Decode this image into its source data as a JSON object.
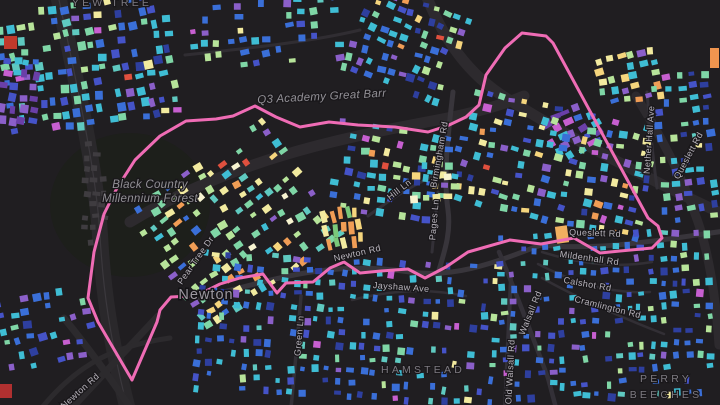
{
  "map": {
    "background": "#201e21",
    "forest_patch": {
      "cx": 130,
      "cy": 205,
      "rx": 80,
      "ry": 72,
      "color": "#1d1f1b"
    },
    "boundary": {
      "name": "ward-boundary",
      "color": "#ef6cb5",
      "width": 3,
      "points": [
        [
          132,
          380
        ],
        [
          98,
          322
        ],
        [
          88,
          298
        ],
        [
          94,
          252
        ],
        [
          104,
          214
        ],
        [
          117,
          188
        ],
        [
          135,
          160
        ],
        [
          160,
          136
        ],
        [
          186,
          121
        ],
        [
          216,
          119
        ],
        [
          233,
          116
        ],
        [
          255,
          106
        ],
        [
          276,
          117
        ],
        [
          300,
          127
        ],
        [
          329,
          122
        ],
        [
          358,
          125
        ],
        [
          395,
          127
        ],
        [
          428,
          132
        ],
        [
          447,
          126
        ],
        [
          466,
          117
        ],
        [
          479,
          105
        ],
        [
          486,
          75
        ],
        [
          505,
          48
        ],
        [
          522,
          33
        ],
        [
          546,
          36
        ],
        [
          553,
          43
        ],
        [
          648,
          218
        ],
        [
          658,
          226
        ],
        [
          662,
          238
        ],
        [
          652,
          248
        ],
        [
          620,
          251
        ],
        [
          600,
          253
        ],
        [
          574,
          238
        ],
        [
          541,
          244
        ],
        [
          510,
          240
        ],
        [
          468,
          252
        ],
        [
          446,
          267
        ],
        [
          425,
          278
        ],
        [
          408,
          269
        ],
        [
          381,
          271
        ],
        [
          360,
          273
        ],
        [
          344,
          262
        ],
        [
          330,
          268
        ],
        [
          313,
          282
        ],
        [
          286,
          283
        ],
        [
          277,
          293
        ],
        [
          263,
          274
        ],
        [
          240,
          278
        ],
        [
          220,
          284
        ],
        [
          206,
          291
        ],
        [
          190,
          296
        ],
        [
          171,
          297
        ],
        [
          160,
          310
        ],
        [
          157,
          322
        ],
        [
          132,
          380
        ]
      ]
    },
    "roads": [
      {
        "d": "M 58,-5 C 78,90 96,170 100,235 C 103,290 110,340 128,410",
        "w": 16,
        "c": "#2a282b"
      },
      {
        "d": "M 58,-5 C 78,90 96,170 100,235 C 103,290 110,340 128,410",
        "w": 1.2,
        "c": "#3b383d"
      },
      {
        "d": "M 158,316 L 70,410",
        "w": 7,
        "c": "#2c2a2d"
      },
      {
        "d": "M 64,318 C 90,350 108,375 132,410",
        "w": 7,
        "c": "#2c2a2d"
      },
      {
        "d": "M 40,410 C 80,360 120,345 170,338",
        "w": 5,
        "c": "#2c2a2d"
      },
      {
        "d": "M 130,222 C 230,162 330,140 432,121 C 470,114 500,106 524,96",
        "w": 11,
        "c": "#2d2a2e"
      },
      {
        "d": "M 426,-5 C 444,40 468,74 506,98 C 570,138 650,180 725,215",
        "w": 11,
        "c": "#2d2a2e"
      },
      {
        "d": "M 636,96 C 660,135 682,175 698,222 C 710,258 716,300 719,345",
        "w": 9,
        "c": "#2d2a2e"
      },
      {
        "d": "M 200,298 C 280,278 330,260 410,272 C 460,279 505,258 541,245 C 600,251 660,240 725,231",
        "w": 5,
        "c": "#38353b"
      },
      {
        "d": "M 453,92 C 448,135 443,175 448,210 C 451,232 445,250 439,270",
        "w": 5,
        "c": "#38353b"
      },
      {
        "d": "M 301,296 C 298,332 295,368 291,408",
        "w": 3.5,
        "c": "#333037"
      },
      {
        "d": "M 511,276 C 509,315 507,360 505,408",
        "w": 4,
        "c": "#333037"
      },
      {
        "d": "M 499,252 C 516,292 532,335 548,378 L 556,408",
        "w": 4.5,
        "c": "#333037"
      },
      {
        "d": "M 368,216 C 390,200 410,186 434,176",
        "w": 3,
        "c": "#333037"
      },
      {
        "d": "M 438,192 L 432,252",
        "w": 3,
        "c": "#333037"
      },
      {
        "d": "M 647,92 C 650,128 653,158 657,188",
        "w": 3,
        "c": "#333037"
      },
      {
        "d": "M 542,252 C 580,264 618,268 652,262",
        "w": 2.5,
        "c": "#322f35"
      },
      {
        "d": "M 538,264 C 576,284 614,294 650,292",
        "w": 2.5,
        "c": "#322f35"
      },
      {
        "d": "M 542,278 C 585,302 628,320 664,334",
        "w": 2.5,
        "c": "#322f35"
      },
      {
        "d": "M 352,300 C 392,290 428,288 466,296",
        "w": 2.5,
        "c": "#322f35"
      },
      {
        "d": "M 185,55 C 250,48 310,42 360,30",
        "w": 3,
        "c": "#302d32"
      }
    ],
    "palettes": {
      "cool": [
        [
          "#3fbdd4",
          22
        ],
        [
          "#3a6fd8",
          20
        ],
        [
          "#4553c8",
          12
        ],
        [
          "#7fd6a6",
          10
        ],
        [
          "#b7e49a",
          7
        ],
        [
          "#8b5fc9",
          8
        ],
        [
          "#f2ea9f",
          4
        ],
        [
          "#2e3f9f",
          8
        ],
        [
          "#c75fd0",
          3
        ],
        [
          "#5fc9c0",
          5
        ],
        [
          "#e0503e",
          1
        ]
      ],
      "coolMix": [
        [
          "#3fbdd4",
          18
        ],
        [
          "#3a6fd8",
          14
        ],
        [
          "#7fd6a6",
          14
        ],
        [
          "#b7e49a",
          12
        ],
        [
          "#f2ea9f",
          8
        ],
        [
          "#4553c8",
          8
        ],
        [
          "#8b5fc9",
          7
        ],
        [
          "#f5d57d",
          5
        ],
        [
          "#2e3f9f",
          6
        ],
        [
          "#c75fd0",
          3
        ],
        [
          "#f09d55",
          3
        ],
        [
          "#e0503e",
          2
        ]
      ],
      "coolDense": [
        [
          "#3fbdd4",
          24
        ],
        [
          "#3a6fd8",
          24
        ],
        [
          "#4553c8",
          14
        ],
        [
          "#5fc9c0",
          8
        ],
        [
          "#7fd6a6",
          8
        ],
        [
          "#2e3f9f",
          8
        ],
        [
          "#8b5fc9",
          6
        ],
        [
          "#b7e49a",
          4
        ],
        [
          "#c75fd0",
          2
        ],
        [
          "#f2ea9f",
          2
        ]
      ],
      "pastel": [
        [
          "#b7e49a",
          18
        ],
        [
          "#f2ea9f",
          16
        ],
        [
          "#7fd6a6",
          16
        ],
        [
          "#f5d57d",
          10
        ],
        [
          "#5fc9c0",
          12
        ],
        [
          "#3fbdd4",
          10
        ],
        [
          "#f09d55",
          6
        ],
        [
          "#8b5fc9",
          4
        ],
        [
          "#3a6fd8",
          4
        ],
        [
          "#e0503e",
          2
        ],
        [
          "#f7f3d0",
          2
        ]
      ],
      "purple": [
        [
          "#8b5fc9",
          30
        ],
        [
          "#6a3fa8",
          20
        ],
        [
          "#3fbdd4",
          15
        ],
        [
          "#3a6fd8",
          12
        ],
        [
          "#c75fd0",
          10
        ],
        [
          "#4553c8",
          8
        ],
        [
          "#f2ea9f",
          3
        ],
        [
          "#e0503e",
          2
        ]
      ],
      "warmMix": [
        [
          "#f2ea9f",
          20
        ],
        [
          "#f5d57d",
          15
        ],
        [
          "#3fbdd4",
          20
        ],
        [
          "#7fd6a6",
          12
        ],
        [
          "#3a6fd8",
          10
        ],
        [
          "#f09d55",
          8
        ],
        [
          "#b7e49a",
          10
        ],
        [
          "#8b5fc9",
          5
        ]
      ],
      "warm": [
        [
          "#f09d55",
          25
        ],
        [
          "#e0503e",
          15
        ],
        [
          "#f5d57d",
          20
        ],
        [
          "#f2ea9f",
          10
        ],
        [
          "#7ac87a",
          15
        ],
        [
          "#3fbdd4",
          15
        ]
      ],
      "cream": [
        [
          "#f2ea9f",
          30
        ],
        [
          "#f7f3d0",
          20
        ],
        [
          "#f5d57d",
          15
        ],
        [
          "#b7e49a",
          15
        ],
        [
          "#3fbdd4",
          10
        ],
        [
          "#7fd6a6",
          10
        ]
      ],
      "coolPurple": [
        [
          "#3fbdd4",
          22
        ],
        [
          "#3a6fd8",
          18
        ],
        [
          "#8b5fc9",
          16
        ],
        [
          "#4553c8",
          12
        ],
        [
          "#7fd6a6",
          10
        ],
        [
          "#c75fd0",
          8
        ],
        [
          "#2e3f9f",
          8
        ],
        [
          "#b7e49a",
          6
        ]
      ],
      "gray": [
        [
          "#3f3c40",
          100
        ]
      ]
    },
    "clusters": [
      {
        "x": 2,
        "y": 2,
        "cols": 16,
        "rows": 10,
        "dx": 11,
        "dy": 13,
        "angle": -8,
        "palette": "cool",
        "bw": [
          5,
          9
        ],
        "bh": [
          5,
          9
        ],
        "skip": 0.25
      },
      {
        "x": 0,
        "y": 58,
        "cols": 4,
        "rows": 6,
        "dx": 10,
        "dy": 12,
        "angle": 5,
        "palette": "purple",
        "bw": [
          5,
          9
        ],
        "bh": [
          5,
          9
        ],
        "skip": 0.2
      },
      {
        "x": 190,
        "y": 0,
        "cols": 13,
        "rows": 6,
        "dx": 12,
        "dy": 12,
        "angle": -5,
        "palette": "cool",
        "bw": [
          5,
          9
        ],
        "bh": [
          4,
          8
        ],
        "skip": 0.45
      },
      {
        "x": 352,
        "y": 0,
        "cols": 10,
        "rows": 8,
        "dx": 11,
        "dy": 12,
        "angle": 20,
        "palette": "coolMix",
        "bw": [
          5,
          9
        ],
        "bh": [
          4,
          8
        ],
        "skip": 0.2
      },
      {
        "x": 598,
        "y": 52,
        "cols": 6,
        "rows": 5,
        "dx": 11,
        "dy": 11,
        "angle": -10,
        "palette": "warmMix",
        "bw": [
          5,
          9
        ],
        "bh": [
          4,
          8
        ],
        "skip": 0.25
      },
      {
        "x": 548,
        "y": 108,
        "cols": 5,
        "rows": 5,
        "dx": 11,
        "dy": 10,
        "angle": -25,
        "palette": "purple",
        "bw": [
          5,
          10
        ],
        "bh": [
          4,
          8
        ],
        "skip": 0.2
      },
      {
        "x": 462,
        "y": 108,
        "cols": 17,
        "rows": 10,
        "dx": 11.5,
        "dy": 12,
        "angle": 12,
        "palette": "coolMix",
        "bw": [
          5,
          9
        ],
        "bh": [
          4,
          8
        ],
        "skip": 0.3
      },
      {
        "x": 658,
        "y": 72,
        "cols": 5,
        "rows": 13,
        "dx": 12,
        "dy": 12,
        "angle": -5,
        "palette": "cool",
        "bw": [
          5,
          9
        ],
        "bh": [
          4,
          8
        ],
        "skip": 0.3
      },
      {
        "x": 152,
        "y": 150,
        "cols": 15,
        "rows": 12,
        "dx": 11.5,
        "dy": 12.5,
        "angle": -35,
        "palette": "pastel",
        "bw": [
          5,
          9
        ],
        "bh": [
          4,
          8
        ],
        "skip": 0.35
      },
      {
        "x": 332,
        "y": 128,
        "cols": 11,
        "rows": 8,
        "dx": 12,
        "dy": 12,
        "angle": 8,
        "palette": "coolMix",
        "bw": [
          5,
          9
        ],
        "bh": [
          4,
          8
        ],
        "skip": 0.35
      },
      {
        "x": 412,
        "y": 162,
        "cols": 4,
        "rows": 4,
        "dx": 11,
        "dy": 11,
        "angle": 0,
        "palette": "cream",
        "bw": [
          5,
          9
        ],
        "bh": [
          5,
          8
        ],
        "skip": 0.2
      },
      {
        "x": 324,
        "y": 208,
        "cols": 5,
        "rows": 3,
        "dx": 8,
        "dy": 14,
        "angle": -8,
        "palette": "warm",
        "bw": [
          4,
          6
        ],
        "bh": [
          9,
          13
        ],
        "skip": 0.1
      },
      {
        "x": 196,
        "y": 258,
        "cols": 26,
        "rows": 12,
        "dx": 11.8,
        "dy": 12.2,
        "angle": 3,
        "palette": "coolDense",
        "bw": [
          4,
          8
        ],
        "bh": [
          4,
          8
        ],
        "skip": 0.3
      },
      {
        "x": 500,
        "y": 232,
        "cols": 19,
        "rows": 14,
        "dx": 11.5,
        "dy": 12.3,
        "angle": -2,
        "palette": "coolDense",
        "bw": [
          4,
          8
        ],
        "bh": [
          4,
          8
        ],
        "skip": 0.3
      },
      {
        "x": 2,
        "y": 292,
        "cols": 8,
        "rows": 6,
        "dx": 12,
        "dy": 13,
        "angle": -12,
        "palette": "coolPurple",
        "bw": [
          5,
          9
        ],
        "bh": [
          4,
          8
        ],
        "skip": 0.3
      },
      {
        "x": 82,
        "y": 142,
        "cols": 3,
        "rows": 9,
        "dx": 9,
        "dy": 12,
        "angle": 2,
        "palette": "gray",
        "bw": [
          5,
          8
        ],
        "bh": [
          4,
          6
        ],
        "skip": 0.25
      }
    ],
    "special_buildings": [
      {
        "x": 4,
        "y": 36,
        "w": 13,
        "h": 13,
        "color": "#c0392b",
        "angle": 0
      },
      {
        "x": 0,
        "y": 384,
        "w": 12,
        "h": 14,
        "color": "#b03030",
        "angle": 0
      },
      {
        "x": 556,
        "y": 226,
        "w": 12,
        "h": 17,
        "color": "#f0b060",
        "angle": -8
      },
      {
        "x": 710,
        "y": 48,
        "w": 9,
        "h": 20,
        "color": "#f0954f",
        "angle": 0
      }
    ],
    "labels": [
      {
        "text": "YEW TREE",
        "x": 112,
        "y": 6,
        "rot": 0,
        "cls": "place-label"
      },
      {
        "text": "Q3 Academy Great Barr",
        "x": 322,
        "y": 100,
        "rot": -3,
        "cls": "poi-label"
      },
      {
        "text": "Black Country",
        "x": 150,
        "y": 188,
        "rot": 0,
        "cls": "poi-label"
      },
      {
        "text": "Millennium Forest",
        "x": 150,
        "y": 202,
        "rot": 0,
        "cls": "poi-label"
      },
      {
        "text": "Pear Tree Dr",
        "x": 198,
        "y": 262,
        "rot": -55,
        "cls": "road-label"
      },
      {
        "text": "Newton",
        "x": 206,
        "y": 299,
        "rot": 0,
        "cls": "place-big-label"
      },
      {
        "text": "Newton Rd",
        "x": 358,
        "y": 256,
        "rot": -13,
        "cls": "road-label"
      },
      {
        "text": "Jayshaw Ave",
        "x": 401,
        "y": 290,
        "rot": 4,
        "cls": "road-label"
      },
      {
        "text": "Hill Ln",
        "x": 401,
        "y": 192,
        "rot": -38,
        "cls": "road-label"
      },
      {
        "text": "Pages Ln",
        "x": 437,
        "y": 220,
        "rot": -85,
        "cls": "road-label"
      },
      {
        "text": "Birmingham Rd",
        "x": 442,
        "y": 155,
        "rot": -80,
        "cls": "road-label"
      },
      {
        "text": "Queslett Rd",
        "x": 595,
        "y": 236,
        "rot": 2,
        "cls": "road-label"
      },
      {
        "text": "Mildenhall Rd",
        "x": 589,
        "y": 261,
        "rot": 8,
        "cls": "road-label"
      },
      {
        "text": "Calshot Rd",
        "x": 587,
        "y": 287,
        "rot": 10,
        "cls": "road-label"
      },
      {
        "text": "Cramlington Rd",
        "x": 607,
        "y": 310,
        "rot": 14,
        "cls": "road-label"
      },
      {
        "text": "Nether Hall Ave",
        "x": 652,
        "y": 140,
        "rot": -86,
        "cls": "road-label"
      },
      {
        "text": "Queslett Rd",
        "x": 691,
        "y": 157,
        "rot": -62,
        "cls": "road-label"
      },
      {
        "text": "HAMSTEAD",
        "x": 423,
        "y": 373,
        "rot": 0,
        "cls": "place-label"
      },
      {
        "text": "PERRY",
        "x": 666,
        "y": 382,
        "rot": 0,
        "cls": "place-label"
      },
      {
        "text": "BEECHES",
        "x": 666,
        "y": 398,
        "rot": 0,
        "cls": "place-label"
      },
      {
        "text": "Walsall Rd",
        "x": 533,
        "y": 314,
        "rot": -68,
        "cls": "road-label"
      },
      {
        "text": "Old Walsall Rd",
        "x": 513,
        "y": 372,
        "rot": -87,
        "cls": "road-label"
      },
      {
        "text": "Green Ln",
        "x": 302,
        "y": 336,
        "rot": -85,
        "cls": "road-label"
      },
      {
        "text": "Newton Rd",
        "x": 82,
        "y": 393,
        "rot": -42,
        "cls": "road-label"
      }
    ]
  }
}
